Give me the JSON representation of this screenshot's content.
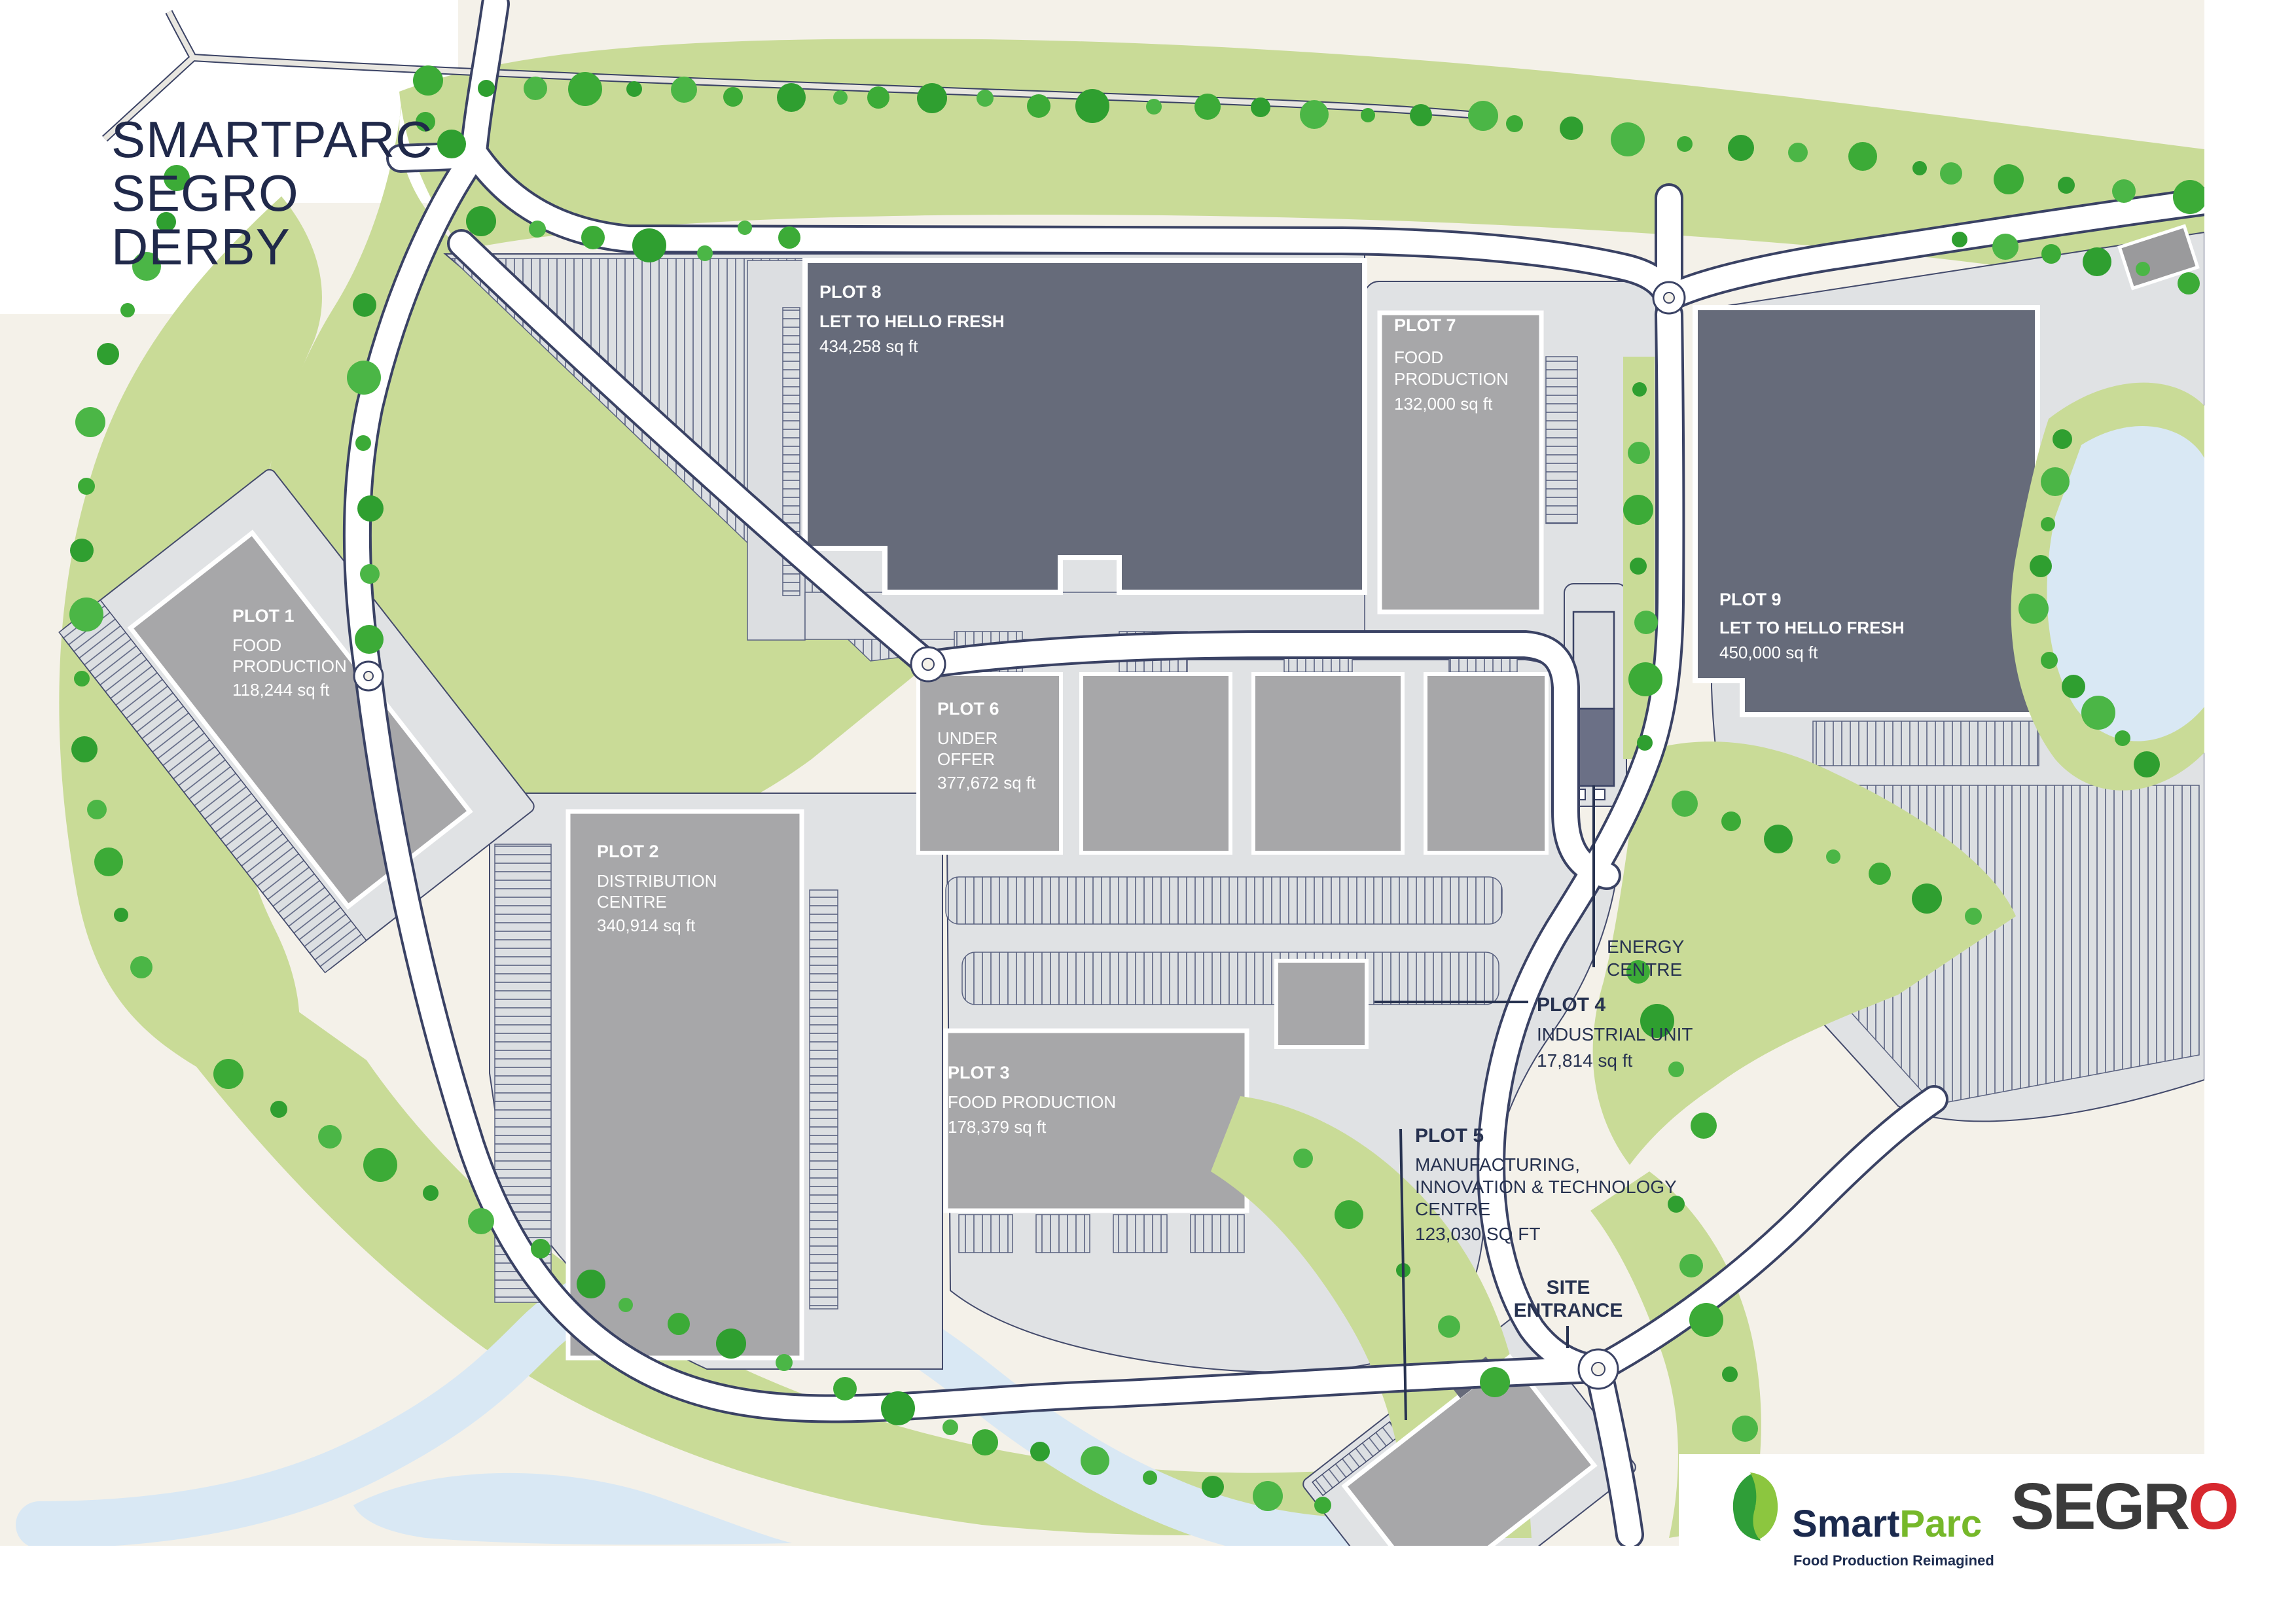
{
  "title": {
    "line1": "SMARTPARC",
    "line2": "SEGRO",
    "line3": "DERBY"
  },
  "plots": {
    "p1": {
      "name": "PLOT 1",
      "l1": "FOOD",
      "l2": "PRODUCTION",
      "area": "118,244 sq ft"
    },
    "p2": {
      "name": "PLOT 2",
      "l1": "DISTRIBUTION",
      "l2": "CENTRE",
      "area": "340,914 sq ft"
    },
    "p3": {
      "name": "PLOT 3",
      "l1": "FOOD PRODUCTION",
      "area": "178,379 sq ft"
    },
    "p4": {
      "name": "PLOT 4",
      "l1": "INDUSTRIAL UNIT",
      "area": "17,814 sq ft"
    },
    "p5": {
      "name": "PLOT 5",
      "l1": "MANUFACTURING,",
      "l2": "INNOVATION & TECHNOLOGY",
      "l3": "CENTRE",
      "area": "123,030 SQ FT"
    },
    "p6": {
      "name": "PLOT 6",
      "l1": "UNDER",
      "l2": "OFFER",
      "area": "377,672 sq ft"
    },
    "p7": {
      "name": "PLOT 7",
      "l1": "FOOD",
      "l2": "PRODUCTION",
      "area": "132,000 sq ft"
    },
    "p8": {
      "name": "PLOT 8",
      "l1": "LET TO HELLO FRESH",
      "area": "434,258 sq ft"
    },
    "p9": {
      "name": "PLOT 9",
      "l1": "LET TO HELLO FRESH",
      "area": "450,000 sq ft"
    }
  },
  "annotations": {
    "energy1": "ENERGY",
    "energy2": "CENTRE",
    "site1": "SITE",
    "site2": "ENTRANCE"
  },
  "logos": {
    "smart": "Smart",
    "parc": "Parc",
    "tagline": "Food Production Reimagined",
    "segro_text": "SEGR",
    "segro_o": "O"
  },
  "colors": {
    "navy": "#273250",
    "cream": "#f4f1e9",
    "green_band": "#c9db97",
    "tree_green": "#3cab37",
    "building_dark": "#666b7a",
    "building_grey": "#a7a7a9",
    "parcel_grey": "#e0e2e4",
    "water": "#d9e8f4",
    "parc_green": "#76b82a",
    "segro_red": "#d7282e"
  }
}
